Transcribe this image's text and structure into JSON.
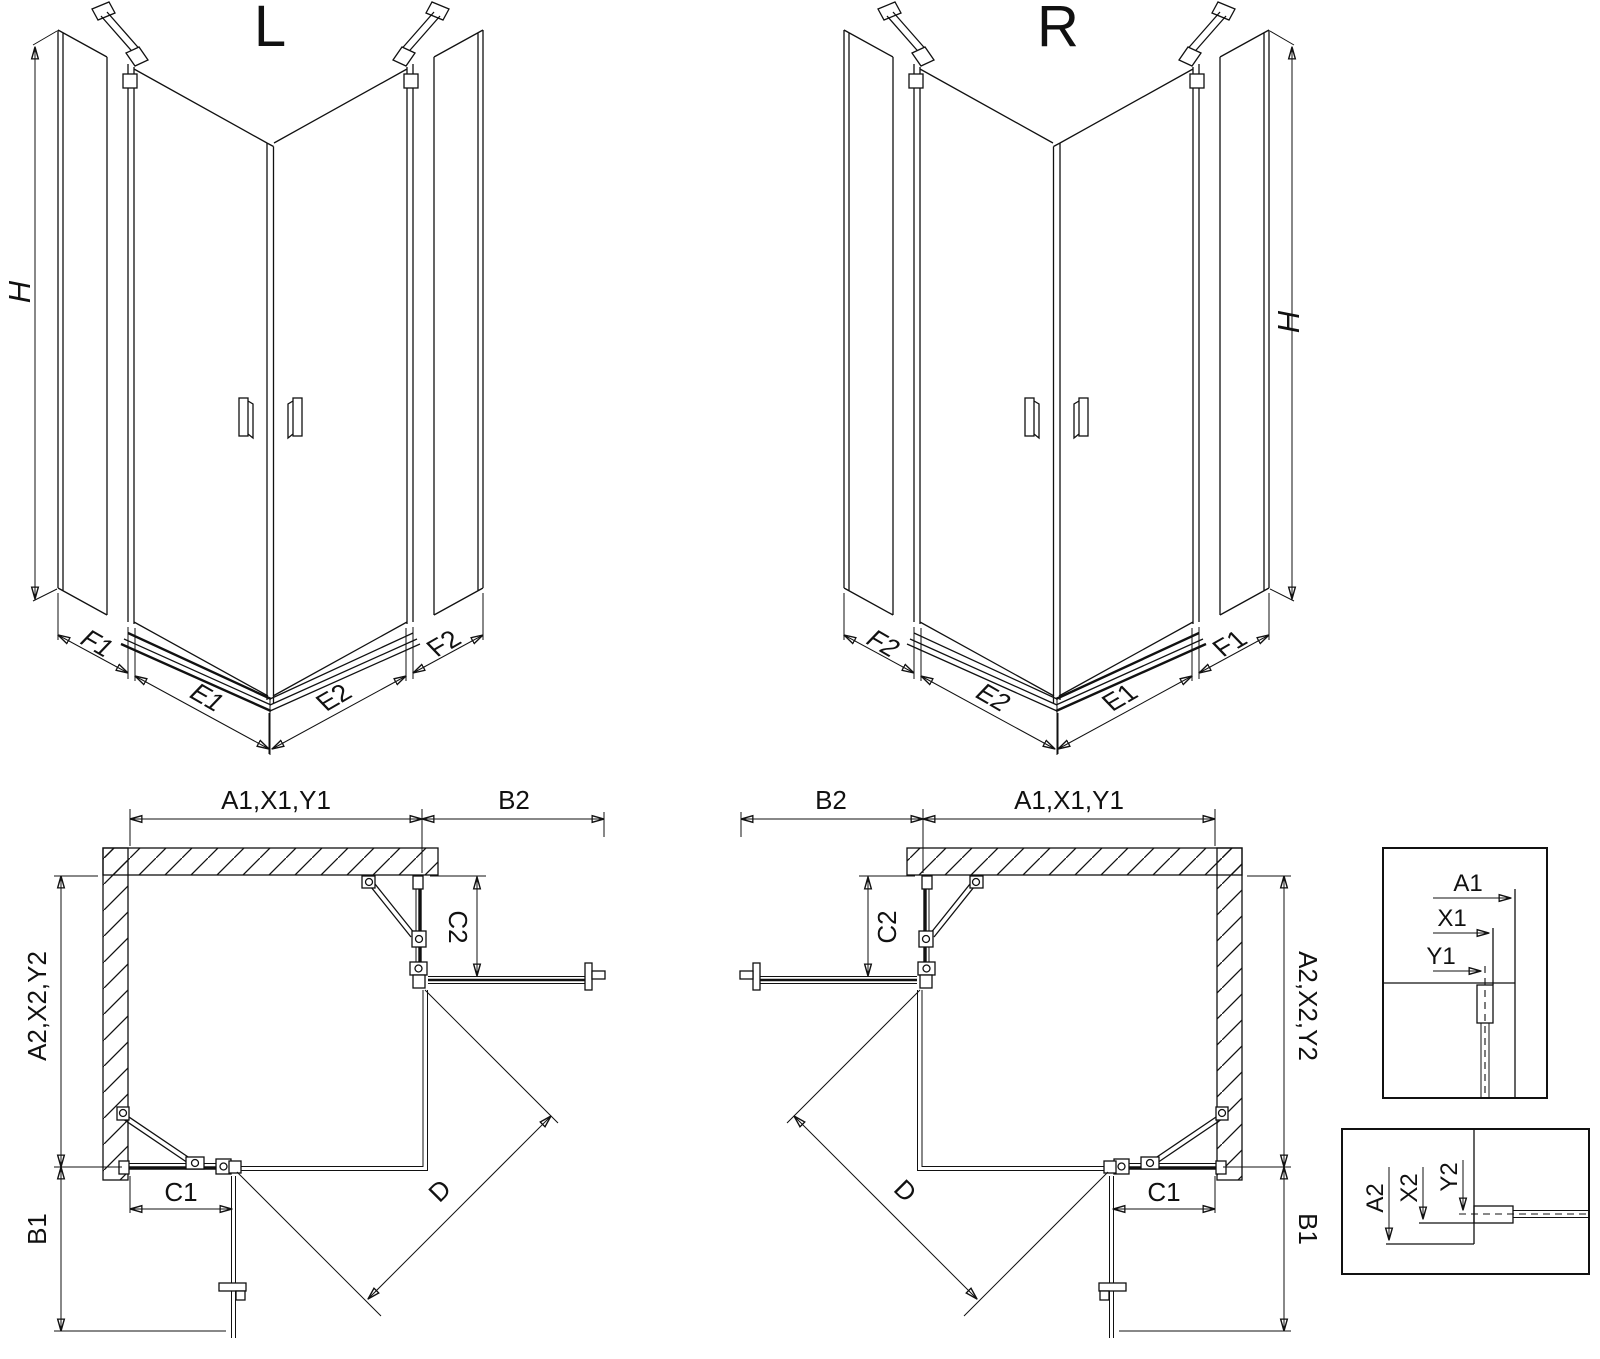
{
  "page": {
    "background": "#ffffff",
    "line_color": "#111111"
  },
  "iso_left": {
    "title": "L",
    "height_label": "H",
    "bottom_labels": [
      "F1",
      "E1",
      "E2",
      "F2"
    ]
  },
  "iso_right": {
    "title": "R",
    "height_label": "H",
    "bottom_labels": [
      "F2",
      "E2",
      "E1",
      "F1"
    ]
  },
  "plan_left": {
    "top_width_label": "A1,X1,Y1",
    "top_side_label": "B2",
    "return_depth_label": "C2",
    "left_depth_label": "A2,X2,Y2",
    "left_side_label": "B1",
    "door_width_label": "C1",
    "diagonal_label": "D"
  },
  "plan_right": {
    "top_side_label": "B2",
    "top_width_label": "A1,X1,Y1",
    "return_depth_label": "C2",
    "right_depth_label": "A2,X2,Y2",
    "right_side_label": "B1",
    "door_width_label": "C1",
    "diagonal_label": "D"
  },
  "detail_top": {
    "a_label": "A1",
    "x_label": "X1",
    "y_label": "Y1"
  },
  "detail_bottom": {
    "a_label": "A2",
    "x_label": "X2",
    "y_label": "Y2"
  }
}
